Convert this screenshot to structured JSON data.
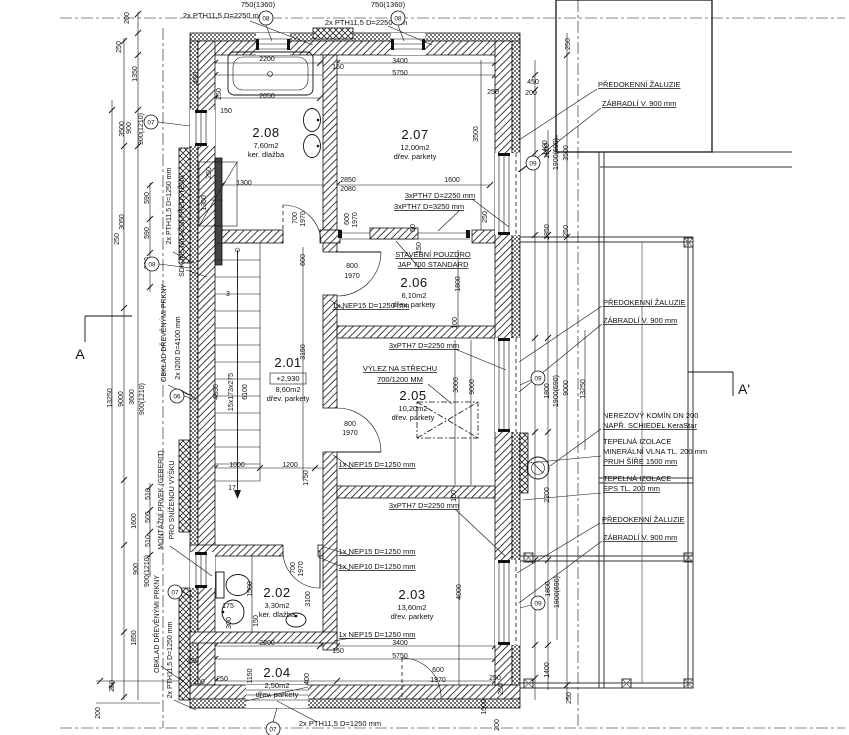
{
  "drawing": {
    "kind": "architectural floor plan",
    "line_color": "#111111",
    "background": "#ffffff",
    "section_mark_left": "A",
    "section_mark_right": "A'"
  },
  "rooms": [
    {
      "number": "2.01",
      "area": "8,60m2",
      "floor": "dřev. parkety",
      "elevation": "+2,930"
    },
    {
      "number": "2.02",
      "area": "3,30m2",
      "floor": "ker. dlažba"
    },
    {
      "number": "2.03",
      "area": "13,60m2",
      "floor": "dřev. parkety"
    },
    {
      "number": "2.04",
      "area": "2,50m2",
      "floor": "dřev. parkety"
    },
    {
      "number": "2.05",
      "area": "10,20m2",
      "floor": "dřev. parkety"
    },
    {
      "number": "2.06",
      "area": "6,10m2",
      "floor": "dřev. parkety"
    },
    {
      "number": "2.07",
      "area": "12,00m2",
      "floor": "dřev. parkety"
    },
    {
      "number": "2.08",
      "area": "7,60m2",
      "floor": "ker. dlažba"
    }
  ],
  "label_groups": [
    {
      "name": "room-number",
      "cls": "t-rnum",
      "anchor": "middle",
      "items": [
        {
          "t": "2.08",
          "x": 266,
          "y": 137
        },
        {
          "t": "2.07",
          "x": 415,
          "y": 139
        },
        {
          "t": "2.06",
          "x": 414,
          "y": 287
        },
        {
          "t": "2.01",
          "x": 288,
          "y": 367
        },
        {
          "t": "2.05",
          "x": 413,
          "y": 400
        },
        {
          "t": "2.02",
          "x": 277,
          "y": 597
        },
        {
          "t": "2.03",
          "x": 412,
          "y": 599
        },
        {
          "t": "2.04",
          "x": 277,
          "y": 677
        }
      ]
    },
    {
      "name": "room-detail",
      "cls": "t-sub",
      "anchor": "middle",
      "items": [
        {
          "t": "7,60m2",
          "x": 266,
          "y": 148
        },
        {
          "t": "ker. dlažba",
          "x": 266,
          "y": 157
        },
        {
          "t": "12,00m2",
          "x": 415,
          "y": 150
        },
        {
          "t": "dřev. parkety",
          "x": 415,
          "y": 159
        },
        {
          "t": "6,10m2",
          "x": 414,
          "y": 298
        },
        {
          "t": "dřev. parkety",
          "x": 414,
          "y": 307
        },
        {
          "t": "+2,930",
          "x": 288,
          "y": 381
        },
        {
          "t": "8,60m2",
          "x": 288,
          "y": 392
        },
        {
          "t": "dřev. parkety",
          "x": 288,
          "y": 401
        },
        {
          "t": "10,20m2",
          "x": 413,
          "y": 411
        },
        {
          "t": "dřev. parkety",
          "x": 413,
          "y": 420
        },
        {
          "t": "3,30m2",
          "x": 277,
          "y": 608
        },
        {
          "t": "ker. dlažba",
          "x": 277,
          "y": 617
        },
        {
          "t": "13,60m2",
          "x": 412,
          "y": 610
        },
        {
          "t": "dřev. parkety",
          "x": 412,
          "y": 619
        },
        {
          "t": "2,50m2",
          "x": 277,
          "y": 688
        },
        {
          "t": "dřev. parkety",
          "x": 277,
          "y": 697
        }
      ]
    },
    {
      "name": "plan-note",
      "cls": "t-note",
      "anchor": "middle",
      "items": [
        {
          "t": "STAVEBNÍ POUZDRO",
          "x": 433,
          "y": 257,
          "u": 1
        },
        {
          "t": "JAP 700 STANDARD",
          "x": 433,
          "y": 267,
          "u": 1
        },
        {
          "t": "VÝLEZ NA STŘECHU",
          "x": 400,
          "y": 371,
          "u": 1
        },
        {
          "t": "700/1200 MM",
          "x": 400,
          "y": 382,
          "u": 1
        },
        {
          "t": "3xPTH7 D=2250 mm",
          "x": 440,
          "y": 198,
          "u": 1
        },
        {
          "t": "3xPTH7 D=3250 mm",
          "x": 429,
          "y": 209,
          "u": 1
        },
        {
          "t": "3xPTH7 D=2250 mm",
          "x": 424,
          "y": 348,
          "u": 1
        },
        {
          "t": "3xPTH7 D=2250 mm",
          "x": 424,
          "y": 508,
          "u": 1
        },
        {
          "t": "1x NEP15 D=1250 mm",
          "x": 371,
          "y": 308,
          "u": 1
        },
        {
          "t": "1x NEP15 D=1250 mm",
          "x": 377,
          "y": 467,
          "u": 1
        },
        {
          "t": "1x NEP15 D=1250 mm",
          "x": 377,
          "y": 554,
          "u": 1
        },
        {
          "t": "1x NEP10 D=1250 mm",
          "x": 377,
          "y": 569,
          "u": 1
        },
        {
          "t": "1x NEP15 D=1250 mm",
          "x": 377,
          "y": 637,
          "u": 1
        },
        {
          "t": "2x PTH11,5 D=1250 mm",
          "x": 340,
          "y": 726
        },
        {
          "t": "2x PTH11,5 D=2250 mm",
          "x": 224,
          "y": 18
        },
        {
          "t": "2x PTH11,5 D=2250 mm",
          "x": 366,
          "y": 25
        },
        {
          "t": "750(1360)",
          "x": 258,
          "y": 7
        },
        {
          "t": "750(1360)",
          "x": 388,
          "y": 7
        }
      ]
    },
    {
      "name": "right-note",
      "cls": "t-rnote",
      "anchor": "start",
      "items": [
        {
          "t": "PŘEDOKENNÍ ŽALUZIE",
          "x": 598,
          "y": 87,
          "u": 1
        },
        {
          "t": "ZÁBRADLÍ V. 900 mm",
          "x": 602,
          "y": 106,
          "u": 1
        },
        {
          "t": "PŘEDOKENNÍ ŽALUZIE",
          "x": 603,
          "y": 305,
          "u": 1
        },
        {
          "t": "ZÁBRADLÍ V. 900 mm",
          "x": 603,
          "y": 323,
          "u": 1
        },
        {
          "t": "NEREZOVÝ KOMÍN DN 200",
          "x": 603,
          "y": 418
        },
        {
          "t": "NAPŘ. SCHIEDEL KeraStar",
          "x": 603,
          "y": 428,
          "u": 1
        },
        {
          "t": "TEPELNÁ IZOLACE",
          "x": 603,
          "y": 444
        },
        {
          "t": "MINERÁLNÍ VLNA TL. 200 mm",
          "x": 603,
          "y": 454
        },
        {
          "t": "PRUH ŠÍŘE 1500 mm",
          "x": 603,
          "y": 464,
          "u": 1
        },
        {
          "t": "TEPELNÁ IZOLACE",
          "x": 603,
          "y": 481
        },
        {
          "t": "EPS TL. 200 mm",
          "x": 603,
          "y": 491,
          "u": 1
        },
        {
          "t": "PŘEDOKENNÍ ŽALUZIE",
          "x": 602,
          "y": 522,
          "u": 1
        },
        {
          "t": "ZÁBRADLÍ V. 900 mm",
          "x": 603,
          "y": 540,
          "u": 1
        }
      ]
    },
    {
      "name": "left-note",
      "cls": "t-lnote",
      "anchor": "middle",
      "items": [
        {
          "t": "2x PTH11,5 D=1250 mm",
          "x": 171,
          "y": 206,
          "r": -90
        },
        {
          "t": "SDK INSTALAČNÍ PŘEDSTĚNA",
          "x": 184,
          "y": 226,
          "r": -90
        },
        {
          "t": "OBKLAD DŘEVĚNÝMI PRKNY",
          "x": 166,
          "y": 333,
          "r": -90
        },
        {
          "t": "2x I200 D=4100 mm",
          "x": 180,
          "y": 348,
          "r": -90
        },
        {
          "t": "MONTÁŽNÍ PRVEK (GEBERIT)",
          "x": 163,
          "y": 500,
          "r": -90
        },
        {
          "t": "PRO SNÍŽENOU VÝŠKU",
          "x": 174,
          "y": 500,
          "r": -90
        },
        {
          "t": "OBKLAD DŘEVĚNÝMI PRKNY",
          "x": 159,
          "y": 624,
          "r": -90
        },
        {
          "t": "2x PTH11,5 D=1250 mm",
          "x": 172,
          "y": 660,
          "r": -90
        }
      ]
    },
    {
      "name": "dim",
      "cls": "t-dim",
      "anchor": "middle",
      "items": [
        {
          "t": "2200",
          "x": 267,
          "y": 61
        },
        {
          "t": "3400",
          "x": 400,
          "y": 63
        },
        {
          "t": "5750",
          "x": 400,
          "y": 75
        },
        {
          "t": "150",
          "x": 338,
          "y": 69
        },
        {
          "t": "2050",
          "x": 267,
          "y": 98
        },
        {
          "t": "250",
          "x": 221,
          "y": 94,
          "r": -90
        },
        {
          "t": "150",
          "x": 226,
          "y": 113
        },
        {
          "t": "450",
          "x": 198,
          "y": 78,
          "r": -90
        },
        {
          "t": "1300",
          "x": 244,
          "y": 185
        },
        {
          "t": "2850",
          "x": 348,
          "y": 182
        },
        {
          "t": "2080",
          "x": 348,
          "y": 191
        },
        {
          "t": "1600",
          "x": 452,
          "y": 182
        },
        {
          "t": "3500",
          "x": 478,
          "y": 134,
          "r": -90
        },
        {
          "t": "250",
          "x": 487,
          "y": 217,
          "r": -90
        },
        {
          "t": "1300",
          "x": 206,
          "y": 203,
          "r": -90
        },
        {
          "t": "250",
          "x": 211,
          "y": 173,
          "r": -90
        },
        {
          "t": "700",
          "x": 297,
          "y": 218,
          "r": -90
        },
        {
          "t": "1970",
          "x": 305,
          "y": 219,
          "r": -90
        },
        {
          "t": "600",
          "x": 349,
          "y": 219,
          "r": -90
        },
        {
          "t": "1970",
          "x": 357,
          "y": 220,
          "r": -90
        },
        {
          "t": "50",
          "x": 415,
          "y": 228,
          "r": -90
        },
        {
          "t": "150",
          "x": 421,
          "y": 248,
          "r": -90
        },
        {
          "t": "1400",
          "x": 547,
          "y": 148,
          "r": -90
        },
        {
          "t": "250",
          "x": 570,
          "y": 44,
          "r": -90
        },
        {
          "t": "450",
          "x": 533,
          "y": 84
        },
        {
          "t": "200",
          "x": 531,
          "y": 95
        },
        {
          "t": "250",
          "x": 493,
          "y": 94
        },
        {
          "t": "800",
          "x": 352,
          "y": 268
        },
        {
          "t": "1970",
          "x": 352,
          "y": 278
        },
        {
          "t": "600",
          "x": 305,
          "y": 260,
          "r": -90
        },
        {
          "t": "3150",
          "x": 305,
          "y": 352,
          "r": -90
        },
        {
          "t": "1800",
          "x": 460,
          "y": 284,
          "r": -90
        },
        {
          "t": "100",
          "x": 457,
          "y": 323,
          "r": -90
        },
        {
          "t": "800",
          "x": 350,
          "y": 426
        },
        {
          "t": "1970",
          "x": 350,
          "y": 435
        },
        {
          "t": "3000",
          "x": 458,
          "y": 385,
          "r": -90
        },
        {
          "t": "9000",
          "x": 474,
          "y": 387,
          "r": -90
        },
        {
          "t": "1000",
          "x": 237,
          "y": 467
        },
        {
          "t": "1200",
          "x": 290,
          "y": 467
        },
        {
          "t": "1750",
          "x": 308,
          "y": 478,
          "r": -90
        },
        {
          "t": "4850",
          "x": 218,
          "y": 392,
          "r": -90
        },
        {
          "t": "15x173x275",
          "x": 233,
          "y": 392,
          "r": -90
        },
        {
          "t": "6100",
          "x": 247,
          "y": 392,
          "r": -90
        },
        {
          "t": "3",
          "x": 228,
          "y": 296
        },
        {
          "t": "17",
          "x": 232,
          "y": 490
        },
        {
          "t": "100",
          "x": 456,
          "y": 496,
          "r": -90
        },
        {
          "t": "1500",
          "x": 252,
          "y": 589,
          "r": -90
        },
        {
          "t": "175",
          "x": 228,
          "y": 608
        },
        {
          "t": "150",
          "x": 258,
          "y": 621,
          "r": -90
        },
        {
          "t": "300",
          "x": 231,
          "y": 623,
          "r": -90
        },
        {
          "t": "700",
          "x": 295,
          "y": 568,
          "r": -90
        },
        {
          "t": "1970",
          "x": 303,
          "y": 569,
          "r": -90
        },
        {
          "t": "3100",
          "x": 310,
          "y": 599,
          "r": -90
        },
        {
          "t": "4000",
          "x": 461,
          "y": 592,
          "r": -90
        },
        {
          "t": "2200",
          "x": 267,
          "y": 645
        },
        {
          "t": "3400",
          "x": 400,
          "y": 645
        },
        {
          "t": "150",
          "x": 338,
          "y": 653
        },
        {
          "t": "5750",
          "x": 400,
          "y": 658
        },
        {
          "t": "250",
          "x": 222,
          "y": 681
        },
        {
          "t": "1150",
          "x": 252,
          "y": 676,
          "r": -90
        },
        {
          "t": "400",
          "x": 309,
          "y": 679,
          "r": -90
        },
        {
          "t": "600",
          "x": 438,
          "y": 672
        },
        {
          "t": "1970",
          "x": 438,
          "y": 682
        },
        {
          "t": "250",
          "x": 495,
          "y": 680
        },
        {
          "t": "250",
          "x": 503,
          "y": 689,
          "r": -90
        },
        {
          "t": "1500",
          "x": 486,
          "y": 707,
          "r": -90
        },
        {
          "t": "200",
          "x": 499,
          "y": 725,
          "r": -90
        },
        {
          "t": "450",
          "x": 193,
          "y": 663
        },
        {
          "t": "200",
          "x": 199,
          "y": 684
        },
        {
          "t": "250",
          "x": 114,
          "y": 686,
          "r": -90
        },
        {
          "t": "200",
          "x": 100,
          "y": 713,
          "r": -90
        },
        {
          "t": "200",
          "x": 129,
          "y": 18,
          "r": -90
        },
        {
          "t": "250",
          "x": 121,
          "y": 47,
          "r": -90
        },
        {
          "t": "1350",
          "x": 137,
          "y": 74,
          "r": -90
        },
        {
          "t": "3500",
          "x": 124,
          "y": 129,
          "r": -90
        },
        {
          "t": "900",
          "x": 131,
          "y": 128,
          "r": -90
        },
        {
          "t": "900(1210)",
          "x": 143,
          "y": 129,
          "r": -90
        },
        {
          "t": "590",
          "x": 149,
          "y": 198,
          "r": -90
        },
        {
          "t": "590",
          "x": 149,
          "y": 233,
          "r": -90
        },
        {
          "t": "590",
          "x": 149,
          "y": 263,
          "r": -90
        },
        {
          "t": "3050",
          "x": 124,
          "y": 222,
          "r": -90
        },
        {
          "t": "250",
          "x": 119,
          "y": 239,
          "r": -90
        },
        {
          "t": "13250",
          "x": 112,
          "y": 398,
          "r": -90
        },
        {
          "t": "9000",
          "x": 123,
          "y": 399,
          "r": -90
        },
        {
          "t": "3600",
          "x": 134,
          "y": 397,
          "r": -90
        },
        {
          "t": "900(1210)",
          "x": 144,
          "y": 399,
          "r": -90
        },
        {
          "t": "510",
          "x": 150,
          "y": 494,
          "r": -90
        },
        {
          "t": "505",
          "x": 150,
          "y": 517,
          "r": -90
        },
        {
          "t": "510",
          "x": 150,
          "y": 541,
          "r": -90
        },
        {
          "t": "1600",
          "x": 136,
          "y": 521,
          "r": -90
        },
        {
          "t": "900",
          "x": 138,
          "y": 569,
          "r": -90
        },
        {
          "t": "900(1210)",
          "x": 149,
          "y": 571,
          "r": -90
        },
        {
          "t": "1850",
          "x": 136,
          "y": 638,
          "r": -90
        },
        {
          "t": "1800",
          "x": 549,
          "y": 151,
          "r": -90
        },
        {
          "t": "1900(690)",
          "x": 558,
          "y": 154,
          "r": -90
        },
        {
          "t": "3500",
          "x": 568,
          "y": 153,
          "r": -90
        },
        {
          "t": "2850",
          "x": 549,
          "y": 232,
          "r": -90
        },
        {
          "t": "250",
          "x": 568,
          "y": 231,
          "r": -90
        },
        {
          "t": "1800",
          "x": 549,
          "y": 391,
          "r": -90
        },
        {
          "t": "1900(690)",
          "x": 558,
          "y": 391,
          "r": -90
        },
        {
          "t": "9000",
          "x": 568,
          "y": 388,
          "r": -90
        },
        {
          "t": "13250",
          "x": 585,
          "y": 389,
          "r": -90
        },
        {
          "t": "2200",
          "x": 549,
          "y": 495,
          "r": -90
        },
        {
          "t": "1800",
          "x": 550,
          "y": 589,
          "r": -90
        },
        {
          "t": "1900(690)",
          "x": 559,
          "y": 592,
          "r": -90
        },
        {
          "t": "1400",
          "x": 549,
          "y": 670,
          "r": -90
        },
        {
          "t": "250",
          "x": 571,
          "y": 698,
          "r": -90
        }
      ]
    },
    {
      "name": "ref-marker",
      "cls": "t-marker",
      "anchor": "middle",
      "circle": true,
      "items": [
        {
          "t": "08",
          "x": 266,
          "y": 18
        },
        {
          "t": "08",
          "x": 398,
          "y": 18
        },
        {
          "t": "07",
          "x": 151,
          "y": 122
        },
        {
          "t": "08",
          "x": 152,
          "y": 264
        },
        {
          "t": "06",
          "x": 177,
          "y": 396
        },
        {
          "t": "07",
          "x": 175,
          "y": 592
        },
        {
          "t": "07",
          "x": 273,
          "y": 729
        },
        {
          "t": "09",
          "x": 533,
          "y": 163
        },
        {
          "t": "09",
          "x": 538,
          "y": 378
        },
        {
          "t": "09",
          "x": 538,
          "y": 603
        }
      ]
    },
    {
      "name": "section-mark",
      "cls": "t-section",
      "anchor": "middle",
      "items": [
        {
          "t": "A",
          "x": 80,
          "y": 359
        },
        {
          "t": "A'",
          "x": 744,
          "y": 394
        }
      ]
    }
  ]
}
